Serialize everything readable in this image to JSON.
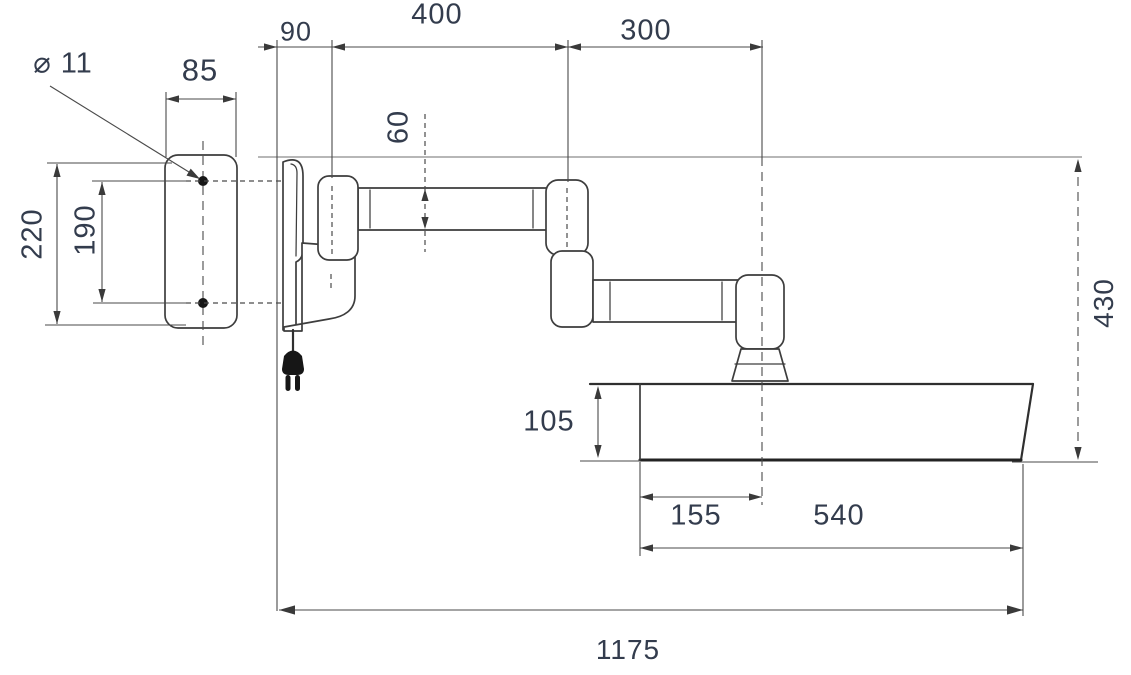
{
  "drawing": {
    "title": "wall-mounted-swing-arm-dimension-drawing",
    "background": "#ffffff",
    "line_color": "#3d3d3d",
    "text_color": "#333c4d",
    "dimensions": {
      "hole_diameter": "⌀ 11",
      "plate_width": "85",
      "plate_height": "220",
      "hole_spacing": "190",
      "bracket_offset": "90",
      "upper_arm_length": "400",
      "forearm_length": "300",
      "arm_tube_height": "60",
      "drop_height": "430",
      "tray_height": "105",
      "tray_inset": "155",
      "tray_length": "540",
      "overall_reach": "1175"
    }
  }
}
